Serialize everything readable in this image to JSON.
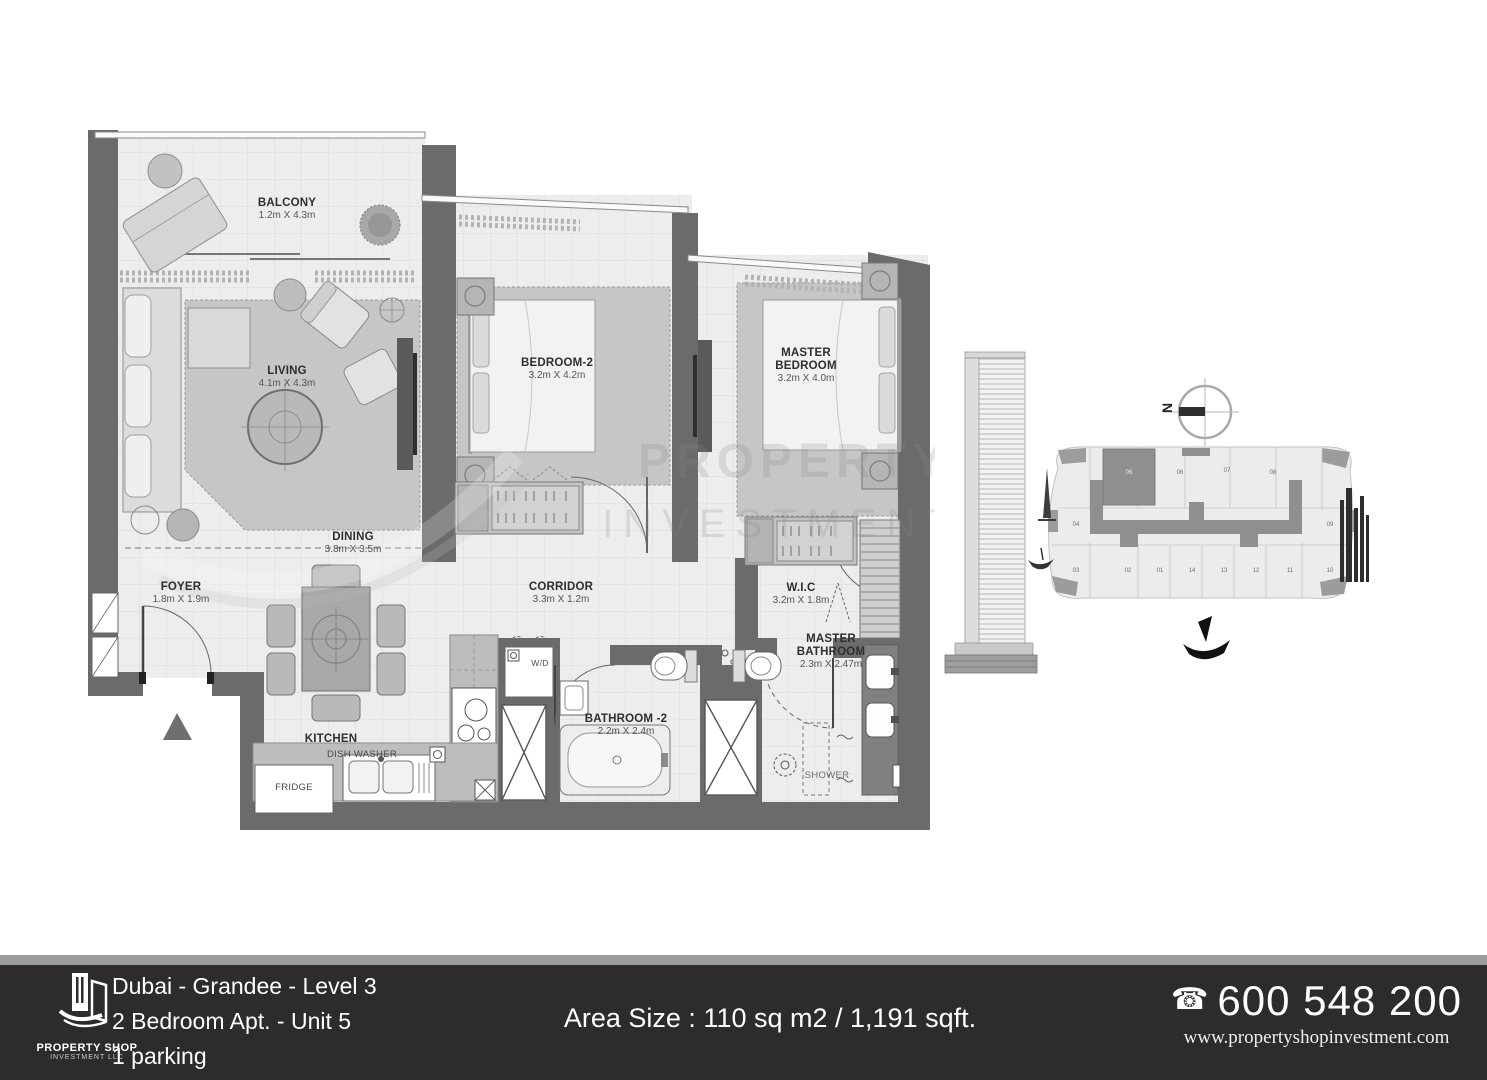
{
  "plan": {
    "rooms": [
      {
        "name": "BALCONY",
        "dims": "1.2m X 4.3m"
      },
      {
        "name": "LIVING",
        "dims": "4.1m X 4.3m"
      },
      {
        "name": "BEDROOM-2",
        "dims": "3.2m X 4.2m"
      },
      {
        "name": "MASTER BEDROOM",
        "dims": "3.2m X 4.0m"
      },
      {
        "name": "DINING",
        "dims": "3.8m X 3.5m"
      },
      {
        "name": "FOYER",
        "dims": "1.8m X 1.9m"
      },
      {
        "name": "CORRIDOR",
        "dims": "3.3m X 1.2m"
      },
      {
        "name": "W.I.C",
        "dims": "3.2m X 1.8m"
      },
      {
        "name": "KITCHEN",
        "dims": ""
      },
      {
        "name": "BATHROOM -2",
        "dims": "2.2m X 2.4m"
      },
      {
        "name": "MASTER BATHROOM",
        "dims": "2.3m X 2.47m"
      }
    ],
    "annotations": {
      "shower": "SHOWER",
      "fridge": "FRIDGE",
      "dishwasher": "DISH WASHER",
      "washer_dryer": "W/D"
    }
  },
  "watermark": {
    "line1": "PROPERTY",
    "line2": "INVESTMENT"
  },
  "siteplan": {
    "north": "N",
    "highlighted_unit": "05",
    "units": [
      "04",
      "05",
      "06",
      "07",
      "08",
      "09",
      "03",
      "02",
      "01",
      "14",
      "13",
      "12",
      "11",
      "10"
    ]
  },
  "footer": {
    "logo": {
      "line1": "PROPERTY SHOP",
      "line2": "INVESTMENT LLC"
    },
    "location": "Dubai - Grandee - Level 3",
    "unit": "2 Bedroom Apt. - Unit 5",
    "parking": "1 parking",
    "area": "Area Size : 110 sq m2 / 1,191 sqft.",
    "phone_icon": "☎",
    "phone": "600 548 200",
    "website": "www.propertyshopinvestment.com",
    "colors": {
      "footer_bg": "#2d2b2b",
      "strip": "#9c9c9c",
      "wall": "#6b6b6b"
    }
  }
}
